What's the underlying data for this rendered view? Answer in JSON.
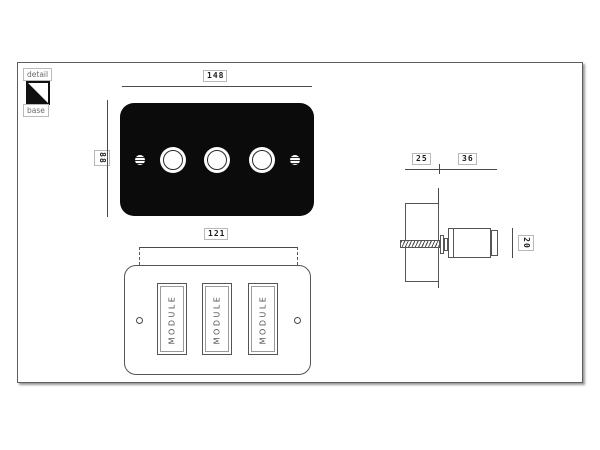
{
  "legend": {
    "detail": "detail",
    "base": "base"
  },
  "front_view": {
    "width_mm": "148",
    "height_mm": "88"
  },
  "bottom_view": {
    "screw_centers_mm": "121",
    "modules": [
      "MODULE",
      "MODULE",
      "MODULE"
    ]
  },
  "side_view": {
    "recess_depth_mm": "25",
    "projection_mm": "36",
    "knob_diameter_mm": "20"
  },
  "colors": {
    "line": "#4a4a4a",
    "plate": "#0b0b0b",
    "label_border": "#b8b8b8",
    "muted_text": "#555555"
  }
}
